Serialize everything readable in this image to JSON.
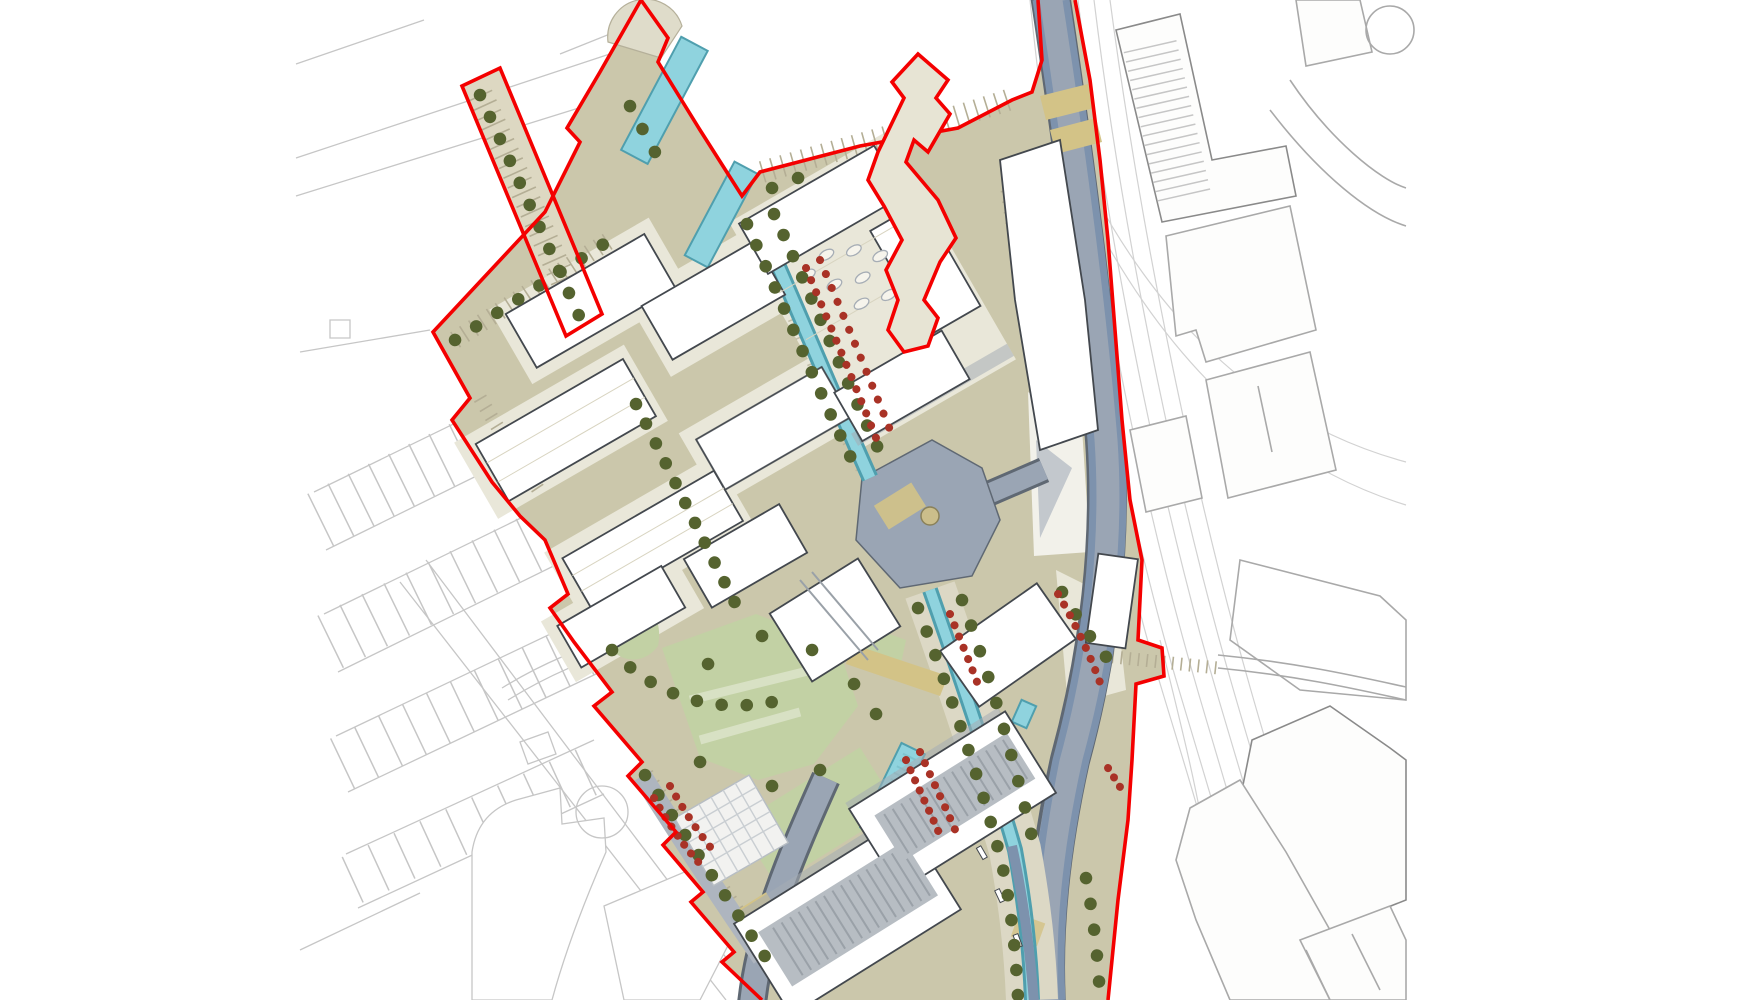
{
  "palette": {
    "background": "#ffffff",
    "context_outline_light": "#c6c6c6",
    "context_outline_mid": "#a9a9a9",
    "context_outline_dark": "#8a8a8a",
    "context_fill": "#fdfdfc",
    "railway_line": "#d2d2d2",
    "street_paving": "#cbc7ab",
    "street_paving_light": "#e9e7d9",
    "promenade_paving": "#dcd8c5",
    "hatch_tick": "#b4ae95",
    "building_fill": "#ffffff",
    "building_outline": "#43484e",
    "building_shadow": "#a6adb5",
    "roof_grey": "#b7bdc3",
    "roof_stripe": "#9aa1a8",
    "water_fill": "#8fd3de",
    "water_edge": "#4f9fae",
    "water_steel": "#7d92ad",
    "road_surface": "#9aa5b4",
    "road_edge": "#5f6873",
    "tree_olive": "#55632f",
    "shrub_red": "#a93226",
    "lawn_green": "#c2d1a4",
    "lawn_stripe": "#d8e1c4",
    "path_khaki": "#d3c387",
    "plaza_fill": "#f2f2f0",
    "plaza_line": "#c9ced2",
    "boundary_red": "#f40000"
  }
}
